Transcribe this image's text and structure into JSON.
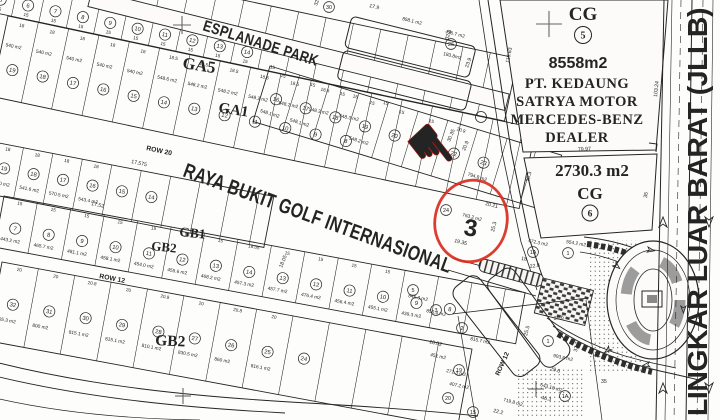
{
  "canvas": {
    "w": 720,
    "h": 420
  },
  "colors": {
    "paper": "#fcfbf9",
    "ink": "#242424",
    "gray": "#8d8d8d",
    "dark": "#2e2e2e",
    "red": "#d92c1f",
    "red_fill": "#e8392b"
  },
  "streets": {
    "esplanade": "ESPLANADE PARK",
    "raya": "RAYA BUKIT GOLF INTERNASIONAL",
    "row20": "ROW 20",
    "row12_west": "ROW 12",
    "row12_south": "ROW 12",
    "jllb": "LINGKAR LUAR BARAT (JLLB)"
  },
  "blocks": {
    "ga5": "GA5",
    "ga1": "GA1",
    "gb1": "GB1",
    "gb2a": "GB2",
    "gb2b": "GB2"
  },
  "cg5": {
    "label": "CG",
    "number": "5",
    "area": "8558m2",
    "owner": [
      "PT. KEDAUNG",
      "SATRYA MOTOR",
      "MERCEDES-BENZ",
      "DEALER"
    ]
  },
  "cg6": {
    "label": "CG",
    "number": "6",
    "area": "2730.3  m2"
  },
  "marker": {
    "number": "3",
    "pointer_glyph": "☛"
  },
  "rows": [
    {
      "name": "row-north",
      "ax": -30,
      "ay": -58,
      "angle": 12,
      "len": 560,
      "h": 64,
      "lotw": 28,
      "num_y": 50,
      "area_y": 0,
      "dim_y": 61,
      "numbers": [
        "",
        "5",
        "6",
        "7",
        "8",
        "9",
        "10",
        "11",
        "12",
        "13",
        "14",
        "",
        "",
        "",
        "",
        "",
        "",
        "",
        "",
        ""
      ],
      "areas": [],
      "dims": [
        "",
        "15",
        "15",
        "15",
        "15",
        "15",
        "15",
        "15",
        "15",
        "15",
        "15",
        "15",
        "",
        "",
        "",
        "",
        "",
        "",
        "",
        ""
      ]
    },
    {
      "name": "row-ga5",
      "ax": 8,
      "ay": 16,
      "angle": 12,
      "len": 540,
      "h": 82,
      "lotw": 31,
      "num_y": 52,
      "area_y": 30,
      "dim_y": 8,
      "numbers": [
        "19",
        "18",
        "17",
        "16",
        "15",
        "14",
        "13",
        "12",
        "11",
        "10",
        "9",
        "8",
        "",
        ""
      ],
      "areas": [
        "540 m2",
        "540 m2",
        "540 m2",
        "540 m2",
        "540 m2",
        "548.6 m2",
        "548.2 m2",
        "548.2 m2",
        "548.2 m2",
        "548.2 m2",
        "548.3 m2",
        "548.3 m2",
        "",
        ""
      ],
      "dims": [
        "18",
        "18",
        "18",
        "18",
        "18",
        "18.5",
        "18.5",
        "18.5",
        "18.5",
        "18.5",
        "18.5",
        "15",
        "15",
        ""
      ]
    },
    {
      "name": "row-ga1",
      "ax": 270,
      "ay": 66,
      "angle": 17,
      "len": 305,
      "h": 58,
      "lotw": 31,
      "num_y": 30,
      "area_y": 47,
      "dim_y": 7,
      "numbers": [
        "16",
        "17",
        "18",
        "19",
        "20",
        "21",
        "22",
        "23",
        ""
      ],
      "areas": [
        "548.1 m2",
        "548.1 m2",
        "",
        "548.2 m2",
        "",
        "",
        "",
        "794.8 m2",
        ""
      ],
      "dims": [
        "15",
        "15",
        "15",
        "15",
        "15",
        "15",
        "20.9",
        "",
        ""
      ]
    },
    {
      "name": "row-ga2",
      "ax": -6,
      "ay": 142,
      "angle": 11,
      "len": 285,
      "h": 52,
      "lotw": 30,
      "num_y": 24,
      "area_y": 41,
      "dim_y": 6,
      "numbers": [
        "19",
        "18",
        "17",
        "16",
        "15",
        "14",
        "",
        ""
      ],
      "areas": [
        "540.0 m2",
        "541.6 m2",
        "570.5 m2",
        "543.4 m2",
        "",
        "",
        "",
        ""
      ],
      "dims": [
        "18",
        "18",
        "18",
        "18",
        "",
        "",
        "",
        ""
      ]
    },
    {
      "name": "row-gb1",
      "ax": 4,
      "ay": 196,
      "angle": 10.5,
      "len": 530,
      "h": 52,
      "lotw": 34,
      "num_y": 30,
      "area_y": 44,
      "dim_y": 6,
      "numbers": [
        "7",
        "8",
        "9",
        "10",
        "11",
        "12",
        "13",
        "14",
        "13",
        "12",
        "11",
        "10",
        "9",
        "8",
        ""
      ],
      "areas": [
        "443.2 m2",
        "465.7 m2",
        "481.1 m2",
        "458.1 m2",
        "454.0 m2",
        "455.6 m2",
        "468.2 m2",
        "457.3 m2",
        "457.7 m2",
        "476.4 m2",
        "456.4 m2",
        "455.1 m2",
        "439.3 m2",
        "",
        ""
      ],
      "dims": [
        "15",
        "15",
        "15",
        "15",
        "15",
        "15",
        "15",
        "18.05",
        "15",
        "15",
        "15",
        "15",
        "",
        "",
        ""
      ]
    },
    {
      "name": "row-gb2",
      "ax": 2,
      "ay": 262,
      "angle": 10.5,
      "len": 478,
      "h": 80,
      "lotw": 37,
      "num_y": 40,
      "area_y": 58,
      "dim_y": 6,
      "numbers": [
        "32",
        "31",
        "30",
        "29",
        "28",
        "27",
        "26",
        "25",
        "24",
        "",
        "",
        "",
        ""
      ],
      "areas": [
        "805.3 m2",
        "800 m2",
        "815.1 m2",
        "815.1 m2",
        "810.1 m2",
        "830.5 m2",
        "860 m2",
        "816.1 m2",
        "",
        "",
        "",
        "",
        ""
      ],
      "dims": [
        "20",
        "20",
        "20.8",
        "20",
        "20.8",
        "20",
        "20.8",
        "20",
        "",
        "",
        "",
        "",
        ""
      ]
    }
  ],
  "extra_circles": [
    [
      "26",
      451,
      44
    ],
    [
      "30",
      329,
      7
    ],
    [
      "1A",
      533,
      252
    ],
    [
      "1",
      568,
      253
    ],
    [
      "1",
      548,
      341
    ],
    [
      "1A",
      565,
      396
    ],
    [
      "5",
      413,
      290
    ],
    [
      "3",
      436,
      310
    ],
    [
      "2",
      462,
      328
    ],
    [
      "19",
      459,
      370
    ],
    [
      "20",
      448,
      398
    ],
    [
      "15",
      473,
      412
    ],
    [
      "24",
      446,
      210
    ]
  ],
  "extra_areas": [
    [
      "858.1 m2",
      402,
      20,
      14
    ],
    [
      "436.7 m2",
      445,
      33,
      14
    ],
    [
      "183.8m2",
      443,
      55,
      14
    ],
    [
      "763.2 m2",
      462,
      216,
      15
    ],
    [
      "472.3 m2",
      528,
      242,
      12
    ],
    [
      "554.2 m2",
      566,
      243,
      10
    ],
    [
      "993.6 m2",
      553,
      357,
      12
    ],
    [
      "643.18 m2",
      540,
      386,
      15
    ],
    [
      "719.8 m2",
      503,
      401,
      15
    ],
    [
      "846.3 m2",
      408,
      297,
      12
    ],
    [
      "856.4 m2",
      426,
      312,
      12
    ],
    [
      "815.7 m2",
      470,
      340,
      12
    ],
    [
      "451 m2",
      430,
      356,
      12
    ],
    [
      "271.3 m2",
      446,
      372,
      12
    ],
    [
      "407.2 m2",
      449,
      385,
      12
    ]
  ],
  "dim_labels": [
    [
      "110.63",
      509,
      63,
      -79
    ],
    [
      "103.24",
      657,
      97,
      -84
    ],
    [
      "79.97",
      578,
      151,
      -3
    ],
    [
      "26.3",
      529,
      182,
      -76
    ],
    [
      "35",
      647,
      198,
      -83
    ],
    [
      "22.8",
      530,
      268,
      -8
    ],
    [
      "25.6",
      554,
      320,
      -8
    ],
    [
      "32.7",
      577,
      352,
      -80
    ],
    [
      "29.6",
      550,
      370,
      16
    ],
    [
      "46.3",
      541,
      399,
      12
    ],
    [
      "35",
      601,
      383,
      0
    ],
    [
      "30.35",
      450,
      142,
      -68
    ],
    [
      "20.9",
      465,
      151,
      -68
    ],
    [
      "20.21",
      485,
      205,
      14
    ],
    [
      "19.35",
      454,
      242,
      14
    ],
    [
      "25.3",
      494,
      232,
      -76
    ],
    [
      "17.575",
      131,
      163,
      12
    ],
    [
      "17.52",
      91,
      205,
      12
    ],
    [
      "18.05",
      282,
      268,
      -68
    ],
    [
      "18",
      521,
      260,
      8
    ],
    [
      "32.8",
      448,
      40,
      -70
    ],
    [
      "23.9",
      468,
      68,
      -70
    ],
    [
      "17.9",
      369,
      7,
      14
    ],
    [
      "32.7",
      317,
      6,
      -70
    ],
    [
      "18.02",
      429,
      343,
      14
    ],
    [
      "22.2",
      493,
      412,
      14
    ],
    [
      "25.5",
      527,
      336,
      -75
    ]
  ],
  "crosses": [
    [
      549,
      24,
      13
    ],
    [
      182,
      25,
      9
    ],
    [
      183,
      396,
      8
    ],
    [
      536,
      389,
      8
    ]
  ],
  "jllb_arrows": {
    "up": [
      [
        663,
        222
      ],
      [
        663,
        388
      ]
    ],
    "down": [
      [
        709,
        222
      ],
      [
        709,
        388
      ]
    ]
  },
  "junction_arrows": [
    [
      616,
      262,
      40
    ],
    [
      612,
      350,
      140
    ],
    [
      648,
      247,
      10
    ],
    [
      650,
      367,
      170
    ],
    [
      686,
      306,
      90
    ]
  ]
}
